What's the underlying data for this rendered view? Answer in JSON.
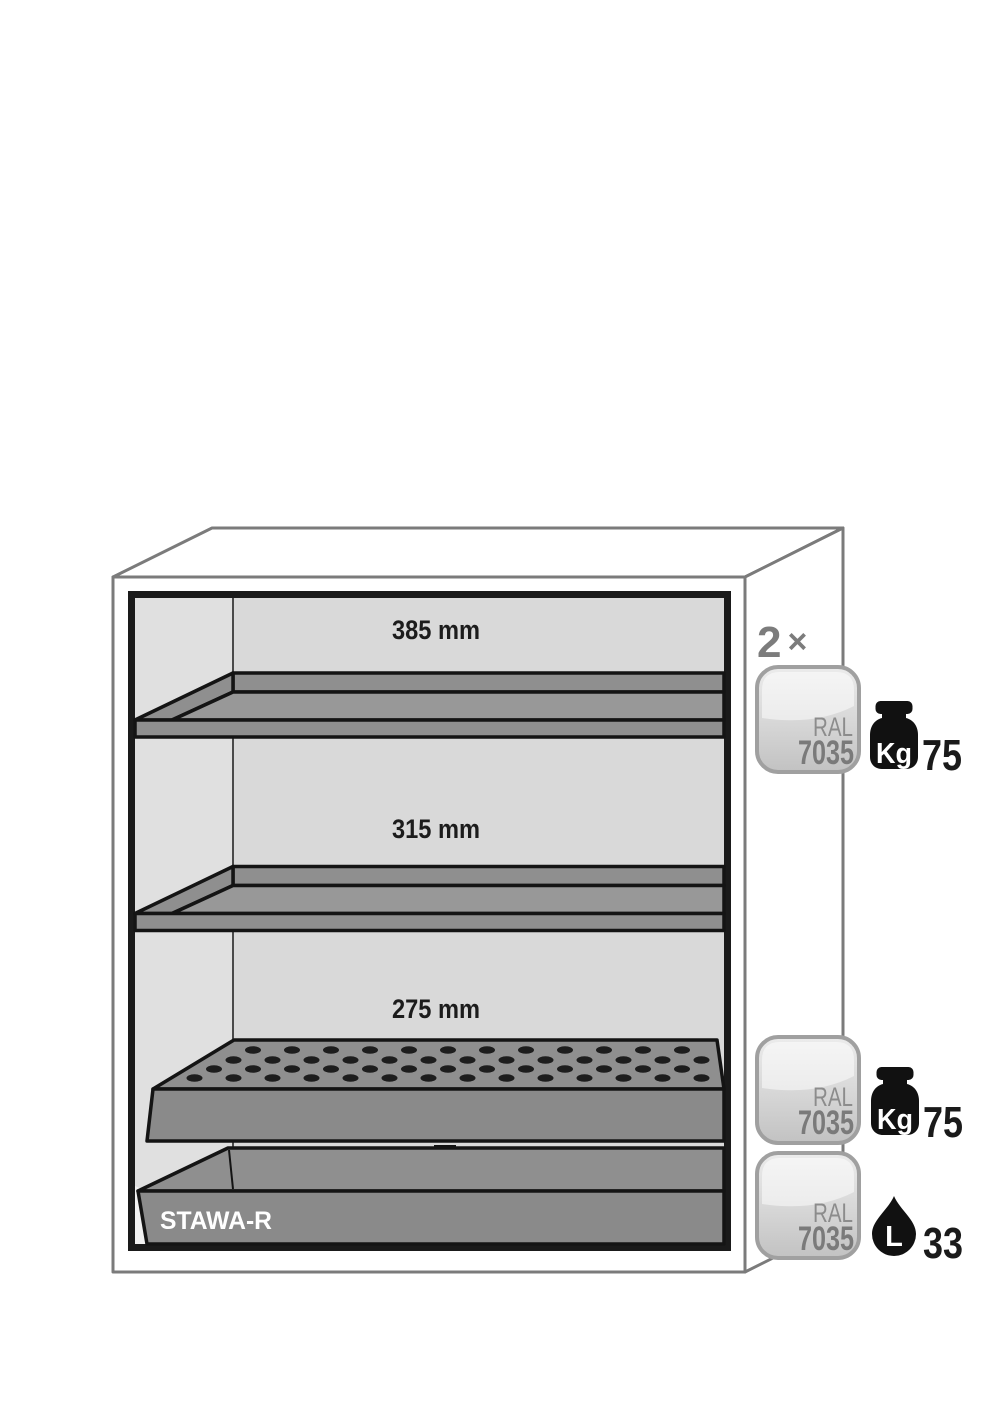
{
  "diagram": {
    "compartments": [
      {
        "height_label": "385 mm"
      },
      {
        "height_label": "315 mm"
      },
      {
        "height_label": "275 mm"
      }
    ],
    "sump": {
      "label": "STAWA-R"
    },
    "shelf_quantity": {
      "count": "2",
      "times": "×"
    },
    "spec_badges": [
      {
        "ral_prefix": "RAL",
        "ral_code": "7035",
        "metric_icon": "weight-kg-icon",
        "metric_unit": "Kg",
        "metric_value": "75"
      },
      {
        "ral_prefix": "RAL",
        "ral_code": "7035",
        "metric_icon": "weight-kg-icon",
        "metric_unit": "Kg",
        "metric_value": "75"
      },
      {
        "ral_prefix": "RAL",
        "ral_code": "7035",
        "metric_icon": "volume-liter-icon",
        "metric_unit": "L",
        "metric_value": "33"
      }
    ],
    "colors": {
      "shelf_gray": "#909090",
      "shelf_top_gray": "#989898",
      "interior_gray": "#d9d9d9",
      "sidewall_gray": "#e0e0e0",
      "outline_gray": "#7b7b7b",
      "frame_ink": "#1a1a1a",
      "badge_border": "#a0a0a0",
      "label_gray": "#7c7c7c",
      "hole_ink": "#1d1d1d"
    }
  }
}
